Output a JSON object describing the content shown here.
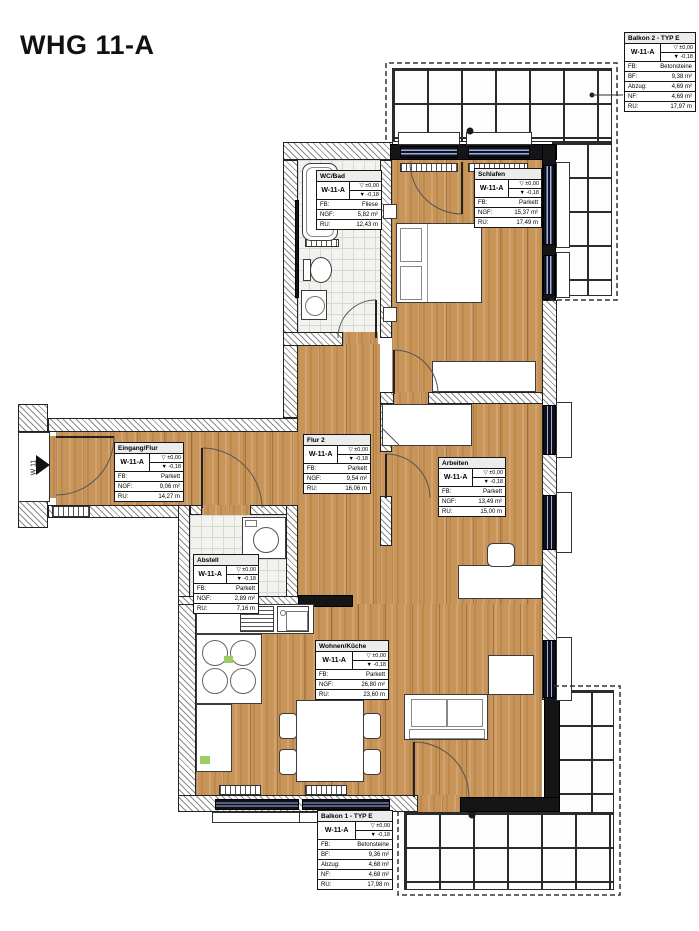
{
  "title": "WHG 11-A",
  "entrance": {
    "label": "W 11"
  },
  "colors": {
    "parquet": "#c89457",
    "tile_floor": "#f2f2ee",
    "balcony_tile_line": "#2b2b2b",
    "wall_black": "#151518",
    "window_glass": "#9fb0e8",
    "drawing_ink": "#222222",
    "highlight_green": "#9ccc65"
  },
  "rooms": [
    {
      "name": "Balkon 2 - TYP E",
      "unit": "W-11-A",
      "level_top": "▽ ±0,00",
      "level_bottom": "▼ -0,18",
      "rows": [
        {
          "k": "FB:",
          "v": "Betonsteine"
        },
        {
          "k": "BF:",
          "v": "9,38 m²"
        },
        {
          "k": "Abzug:",
          "v": "4,69 m²"
        },
        {
          "k": "NF:",
          "v": "4,69 m²"
        },
        {
          "k": "RU:",
          "v": "17,97 m"
        }
      ]
    },
    {
      "name": "WC/Bad",
      "unit": "W-11-A",
      "level_top": "▽ ±0,00",
      "level_bottom": "▼ -0,18",
      "rows": [
        {
          "k": "FB:",
          "v": "Fliese"
        },
        {
          "k": "NGF:",
          "v": "5,82 m²"
        },
        {
          "k": "RU:",
          "v": "12,43 m"
        }
      ]
    },
    {
      "name": "Schlafen",
      "unit": "W-11-A",
      "level_top": "▽ ±0,00",
      "level_bottom": "▼ -0,18",
      "rows": [
        {
          "k": "FB:",
          "v": "Parkett"
        },
        {
          "k": "NGF:",
          "v": "15,37 m²"
        },
        {
          "k": "RU:",
          "v": "17,49 m"
        }
      ]
    },
    {
      "name": "Eingang/Flur",
      "unit": "W-11-A",
      "level_top": "▽ ±0,00",
      "level_bottom": "▼ -0,18",
      "rows": [
        {
          "k": "FB:",
          "v": "Parkett"
        },
        {
          "k": "NGF:",
          "v": "9,06 m²"
        },
        {
          "k": "RU:",
          "v": "14,27 m"
        }
      ]
    },
    {
      "name": "Flur 2",
      "unit": "W-11-A",
      "level_top": "▽ ±0,00",
      "level_bottom": "▼ -0,18",
      "rows": [
        {
          "k": "FB:",
          "v": "Parkett"
        },
        {
          "k": "NGF:",
          "v": "9,54 m²"
        },
        {
          "k": "RU:",
          "v": "16,06 m"
        }
      ]
    },
    {
      "name": "Arbeiten",
      "unit": "W-11-A",
      "level_top": "▽ ±0,00",
      "level_bottom": "▼ -0,18",
      "rows": [
        {
          "k": "FB:",
          "v": "Parkett"
        },
        {
          "k": "NGF:",
          "v": "13,49 m²"
        },
        {
          "k": "RU:",
          "v": "15,00 m"
        }
      ]
    },
    {
      "name": "Abstell",
      "unit": "W-11-A",
      "level_top": "▽ ±0,00",
      "level_bottom": "▼ -0,18",
      "rows": [
        {
          "k": "FB:",
          "v": "Parkett"
        },
        {
          "k": "NGF:",
          "v": "2,89 m²"
        },
        {
          "k": "RU:",
          "v": "7,16 m"
        }
      ]
    },
    {
      "name": "Wohnen/Küche",
      "unit": "W-11-A",
      "level_top": "▽ ±0,00",
      "level_bottom": "▼ -0,18",
      "rows": [
        {
          "k": "FB:",
          "v": "Parkett"
        },
        {
          "k": "NGF:",
          "v": "26,80 m²"
        },
        {
          "k": "RU:",
          "v": "23,60 m"
        }
      ]
    },
    {
      "name": "Balkon 1 - TYP E",
      "unit": "W-11-A",
      "level_top": "▽ ±0,00",
      "level_bottom": "▼ -0,18",
      "rows": [
        {
          "k": "FB:",
          "v": "Betonsteine"
        },
        {
          "k": "BF:",
          "v": "9,36 m²"
        },
        {
          "k": "Abzug:",
          "v": "4,68 m²"
        },
        {
          "k": "NF:",
          "v": "4,68 m²"
        },
        {
          "k": "RU:",
          "v": "17,98 m"
        }
      ]
    }
  ]
}
